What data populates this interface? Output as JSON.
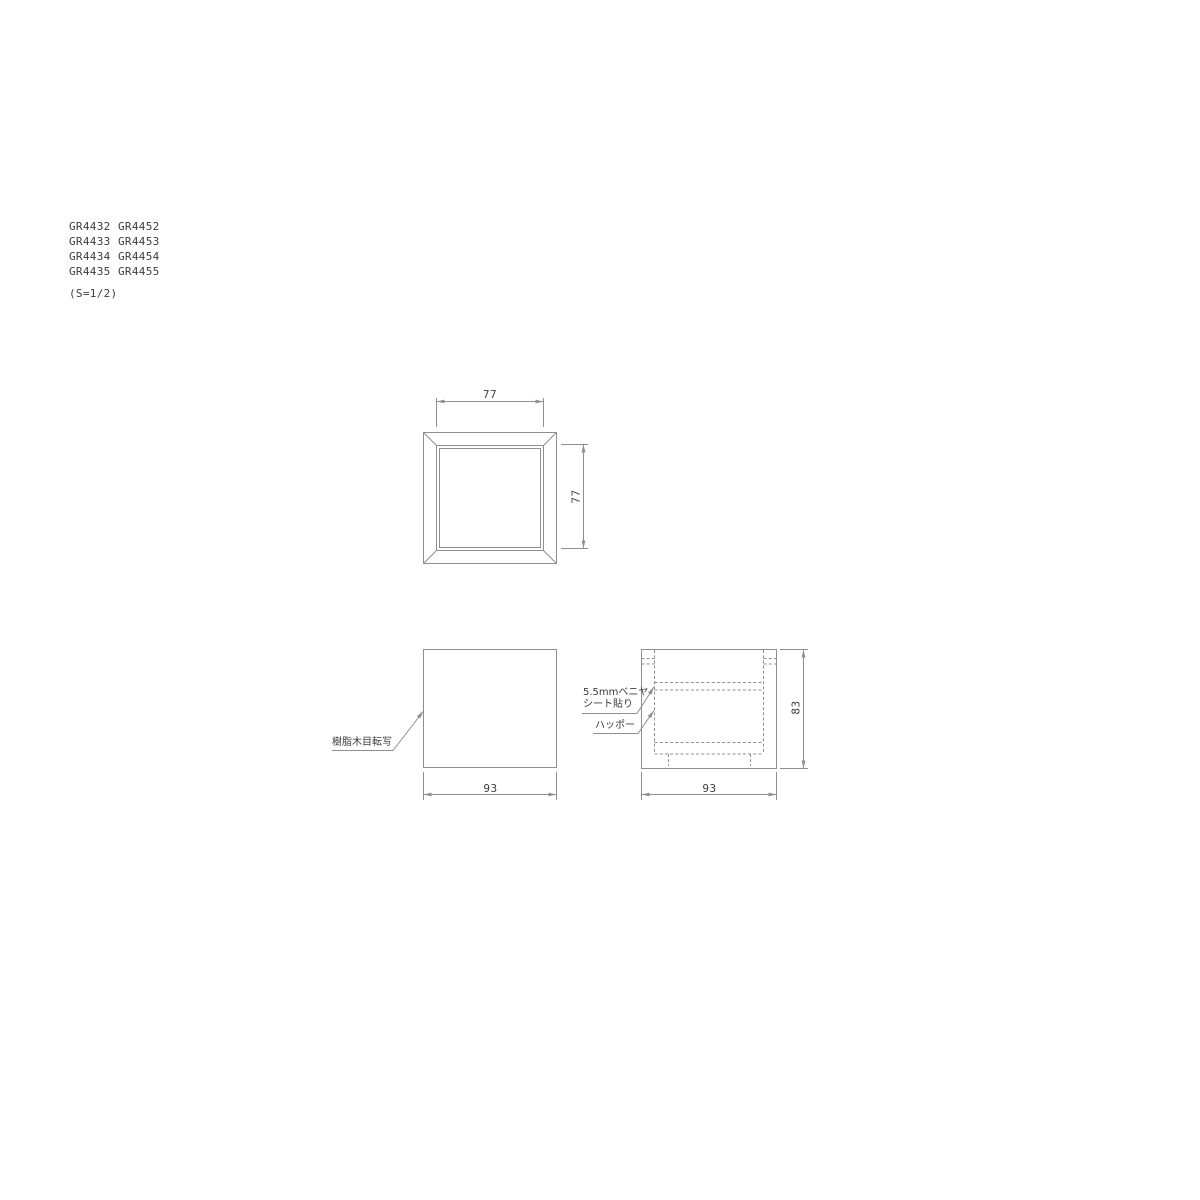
{
  "canvas": {
    "bg": "#ffffff",
    "line_color": "#8f8f8f",
    "text_color": "#3c3c3c"
  },
  "part_list": {
    "rows": [
      [
        "GR4432",
        "GR4452"
      ],
      [
        "GR4433",
        "GR4453"
      ],
      [
        "GR4434",
        "GR4454"
      ],
      [
        "GR4435",
        "GR4455"
      ]
    ],
    "scale_note": "(S=1/2)"
  },
  "top_view": {
    "dim_width": "77",
    "dim_height": "77"
  },
  "front_view": {
    "dim_width": "93",
    "finish_label": "樹脂木目転写"
  },
  "side_view": {
    "dim_width": "93",
    "dim_height": "83",
    "plywood_label_line1": "5.5mmベニヤ",
    "plywood_label_line2": "シート貼り",
    "foam_label": "ハッポー"
  }
}
